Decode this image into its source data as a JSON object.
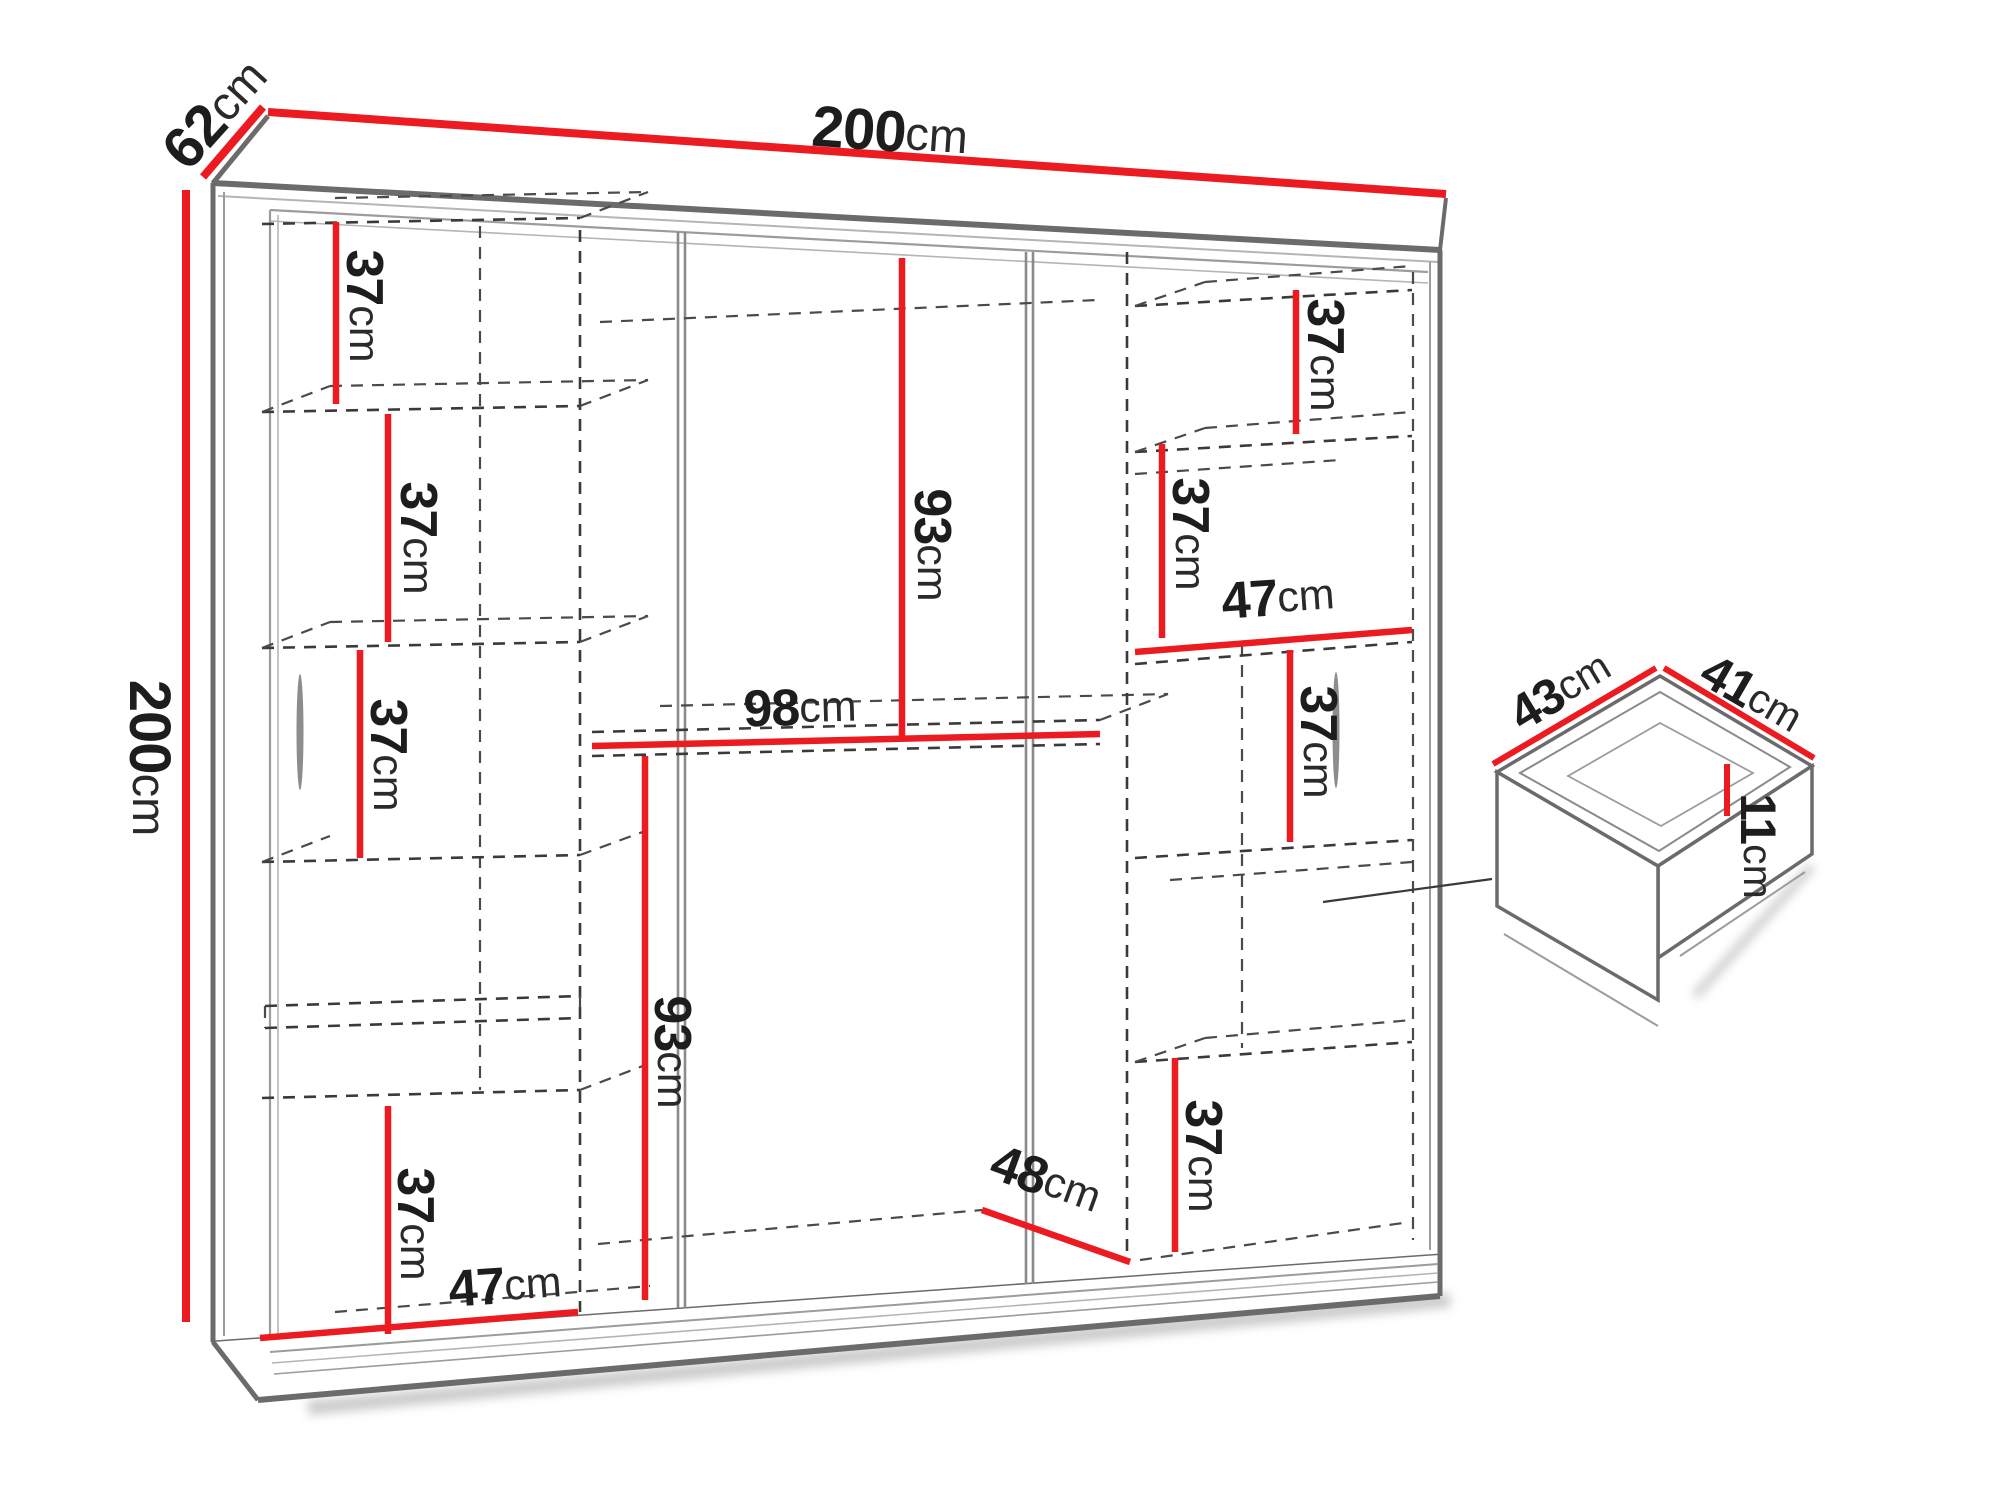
{
  "diagram": {
    "subject": "wardrobe-dimension-diagram",
    "unit": "cm",
    "dimension_line_color": "#ec1b21",
    "outline_color": "#6b6b6b",
    "hidden_line_color": "#3a3a3a",
    "text_color": "#1d1d1d"
  },
  "labels": {
    "top_width": {
      "value": "200",
      "unit": "cm"
    },
    "left_depth": {
      "value": "62",
      "unit": "cm"
    },
    "left_height": {
      "value": "200",
      "unit": "cm"
    },
    "left_shelf_1": {
      "value": "37",
      "unit": "cm"
    },
    "left_shelf_2": {
      "value": "37",
      "unit": "cm"
    },
    "left_shelf_3": {
      "value": "37",
      "unit": "cm"
    },
    "left_shelf_4": {
      "value": "37",
      "unit": "cm"
    },
    "left_col_width": {
      "value": "47",
      "unit": "cm"
    },
    "mid_upper_height": {
      "value": "93",
      "unit": "cm"
    },
    "mid_width": {
      "value": "98",
      "unit": "cm"
    },
    "mid_lower_height": {
      "value": "93",
      "unit": "cm"
    },
    "mid_floor_depth": {
      "value": "48",
      "unit": "cm"
    },
    "right_shelf_1": {
      "value": "37",
      "unit": "cm"
    },
    "right_shelf_2": {
      "value": "37",
      "unit": "cm"
    },
    "right_col_width": {
      "value": "47",
      "unit": "cm"
    },
    "right_shelf_3": {
      "value": "37",
      "unit": "cm"
    },
    "right_shelf_4": {
      "value": "37",
      "unit": "cm"
    },
    "drawer_depth": {
      "value": "43",
      "unit": "cm"
    },
    "drawer_width": {
      "value": "41",
      "unit": "cm"
    },
    "drawer_height": {
      "value": "11",
      "unit": "cm"
    }
  }
}
